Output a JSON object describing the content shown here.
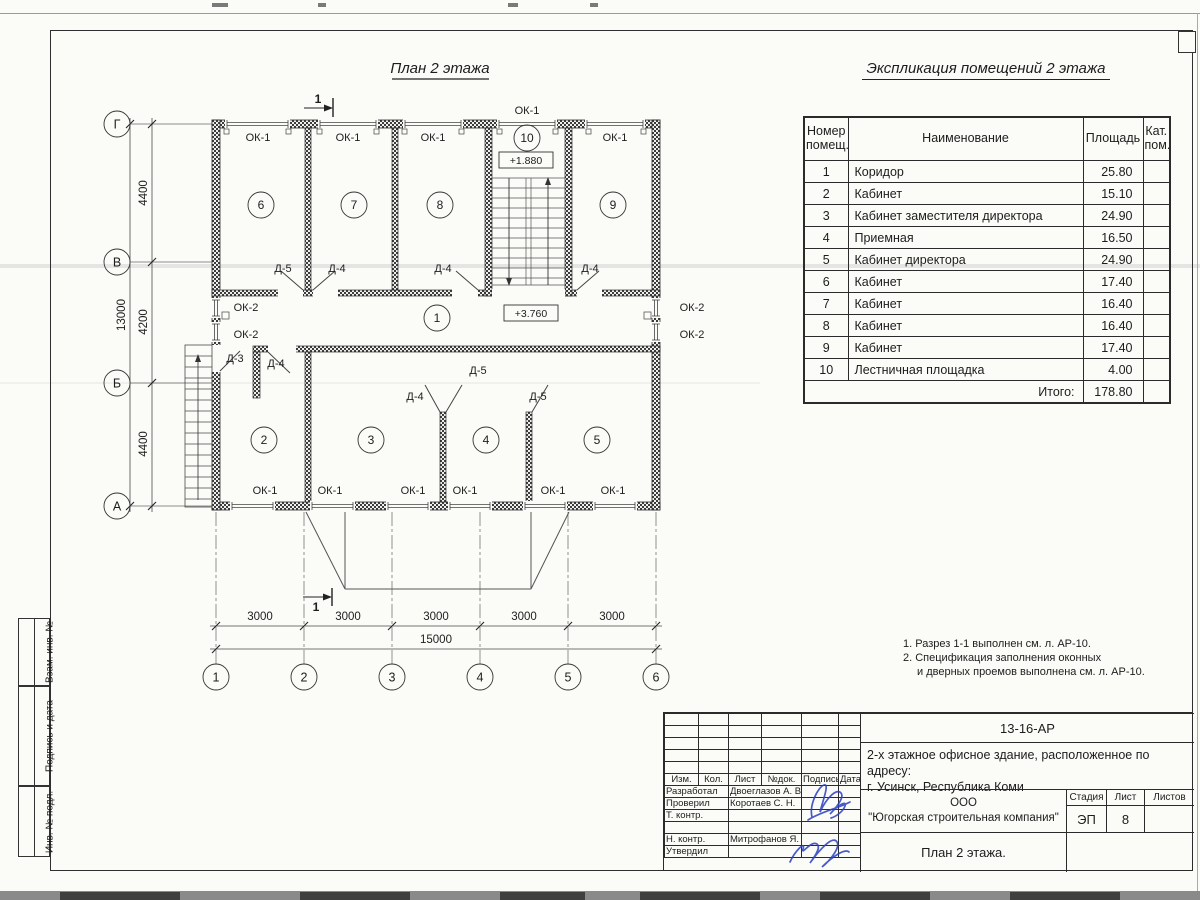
{
  "plan": {
    "title": "План 2 этажа",
    "rooms": [
      {
        "n": "1",
        "x": 437,
        "y": 322
      },
      {
        "n": "2",
        "x": 264,
        "y": 444
      },
      {
        "n": "3",
        "x": 371,
        "y": 444
      },
      {
        "n": "4",
        "x": 486,
        "y": 444
      },
      {
        "n": "5",
        "x": 597,
        "y": 444
      },
      {
        "n": "6",
        "x": 261,
        "y": 209
      },
      {
        "n": "7",
        "x": 354,
        "y": 209
      },
      {
        "n": "8",
        "x": 440,
        "y": 209
      },
      {
        "n": "9",
        "x": 613,
        "y": 209
      },
      {
        "n": "10",
        "x": 527,
        "y": 142
      }
    ],
    "labels": [
      {
        "t": "ОК-1",
        "x": 258,
        "y": 141
      },
      {
        "t": "ОК-1",
        "x": 348,
        "y": 141
      },
      {
        "t": "ОК-1",
        "x": 433,
        "y": 141
      },
      {
        "t": "ОК-1",
        "x": 615,
        "y": 141
      },
      {
        "t": "ОК-1",
        "x": 527,
        "y": 114
      },
      {
        "t": "ОК-1",
        "x": 265,
        "y": 494
      },
      {
        "t": "ОК-1",
        "x": 330,
        "y": 494
      },
      {
        "t": "ОК-1",
        "x": 413,
        "y": 494
      },
      {
        "t": "ОК-1",
        "x": 465,
        "y": 494
      },
      {
        "t": "ОК-1",
        "x": 553,
        "y": 494
      },
      {
        "t": "ОК-1",
        "x": 613,
        "y": 494
      },
      {
        "t": "ОК-2",
        "x": 246,
        "y": 311
      },
      {
        "t": "ОК-2",
        "x": 246,
        "y": 338
      },
      {
        "t": "ОК-2",
        "x": 692,
        "y": 311
      },
      {
        "t": "ОК-2",
        "x": 692,
        "y": 338
      },
      {
        "t": "Д-5",
        "x": 283,
        "y": 272
      },
      {
        "t": "Д-4",
        "x": 337,
        "y": 272
      },
      {
        "t": "Д-4",
        "x": 443,
        "y": 272
      },
      {
        "t": "Д-4",
        "x": 590,
        "y": 272
      },
      {
        "t": "Д-3",
        "x": 235,
        "y": 362
      },
      {
        "t": "Д-4",
        "x": 276,
        "y": 367
      },
      {
        "t": "Д-4",
        "x": 415,
        "y": 400
      },
      {
        "t": "Д-5",
        "x": 478,
        "y": 374
      },
      {
        "t": "Д-5",
        "x": 538,
        "y": 400
      }
    ],
    "elevations": [
      {
        "t": "+1.880",
        "x": 526,
        "y": 164
      },
      {
        "t": "+3.760",
        "x": 531,
        "y": 317
      }
    ],
    "grid_rows": [
      {
        "t": "Г",
        "x": 117,
        "y": 124
      },
      {
        "t": "В",
        "x": 117,
        "y": 262
      },
      {
        "t": "Б",
        "x": 117,
        "y": 383
      },
      {
        "t": "А",
        "x": 117,
        "y": 506
      }
    ],
    "grid_cols": [
      {
        "t": "1",
        "x": 216,
        "y": 677
      },
      {
        "t": "2",
        "x": 304,
        "y": 677
      },
      {
        "t": "3",
        "x": 392,
        "y": 677
      },
      {
        "t": "4",
        "x": 480,
        "y": 677
      },
      {
        "t": "5",
        "x": 568,
        "y": 677
      },
      {
        "t": "6",
        "x": 656,
        "y": 677
      }
    ],
    "dims": [
      {
        "t": "4400",
        "x": 147,
        "y": 193,
        "r": -90
      },
      {
        "t": "4200",
        "x": 147,
        "y": 322,
        "r": -90
      },
      {
        "t": "4400",
        "x": 147,
        "y": 444,
        "r": -90
      },
      {
        "t": "13000",
        "x": 125,
        "y": 315,
        "r": -90
      },
      {
        "t": "3000",
        "x": 260,
        "y": 620,
        "r": 0
      },
      {
        "t": "3000",
        "x": 348,
        "y": 620,
        "r": 0
      },
      {
        "t": "3000",
        "x": 436,
        "y": 620,
        "r": 0
      },
      {
        "t": "3000",
        "x": 524,
        "y": 620,
        "r": 0
      },
      {
        "t": "3000",
        "x": 612,
        "y": 620,
        "r": 0
      },
      {
        "t": "15000",
        "x": 436,
        "y": 643,
        "r": 0
      }
    ],
    "section_marks": [
      {
        "t": "1",
        "x": 318,
        "y": 103
      },
      {
        "t": "1",
        "x": 316,
        "y": 611
      }
    ]
  },
  "table": {
    "title": "Экспликация помещений 2 этажа",
    "headers": {
      "num": "Номер помещ.",
      "name": "Наименование",
      "area": "Площадь",
      "cat": "Кат. пом."
    },
    "rows": [
      {
        "num": "1",
        "name": "Коридор",
        "area": "25.80"
      },
      {
        "num": "2",
        "name": "Кабинет",
        "area": "15.10"
      },
      {
        "num": "3",
        "name": "Кабинет заместителя директора",
        "area": "24.90"
      },
      {
        "num": "4",
        "name": "Приемная",
        "area": "16.50"
      },
      {
        "num": "5",
        "name": "Кабинет директора",
        "area": "24.90"
      },
      {
        "num": "6",
        "name": "Кабинет",
        "area": "17.40"
      },
      {
        "num": "7",
        "name": "Кабинет",
        "area": "16.40"
      },
      {
        "num": "8",
        "name": "Кабинет",
        "area": "16.40"
      },
      {
        "num": "9",
        "name": "Кабинет",
        "area": "17.40"
      },
      {
        "num": "10",
        "name": "Лестничная площадка",
        "area": "4.00"
      }
    ],
    "total_label": "Итого:",
    "total_area": "178.80"
  },
  "notes": {
    "n1": "1. Разрез 1-1 выполнен см. л. АР-10.",
    "n2": "2. Спецификация заполнения оконных",
    "n3": "и дверных проемов выполнена см. л. АР-10."
  },
  "titleblock": {
    "code": "13-16-АР",
    "object_line1": "2-х этажное офисное здание, расположенное по адресу:",
    "object_line2": "г. Усинск, Республика Коми",
    "company_line1": "ООО",
    "company_line2": "\"Югорская строительная компания\"",
    "stage_label": "Стадия",
    "sheet_label": "Лист",
    "sheets_label": "Листов",
    "stage": "ЭП",
    "sheet": "8",
    "sheets": "",
    "drawing_title": "План 2 этажа.",
    "cols": [
      "Изм.",
      "Кол.",
      "Лист",
      "№док.",
      "Подпись",
      "Дата"
    ],
    "staff": [
      {
        "role": "Разработал",
        "name": "Двоеглазов А. В."
      },
      {
        "role": "Проверил",
        "name": "Коротаев С. Н."
      },
      {
        "role": "Т. контр.",
        "name": ""
      },
      {
        "role": "",
        "name": ""
      },
      {
        "role": "Н. контр.",
        "name": "Митрофанов Я. А."
      },
      {
        "role": "Утвердил",
        "name": ""
      }
    ]
  },
  "side_stamp": {
    "s1": "Взам. инв. №",
    "s2": "Подпись и дата",
    "s3": "Инв. № подл."
  }
}
